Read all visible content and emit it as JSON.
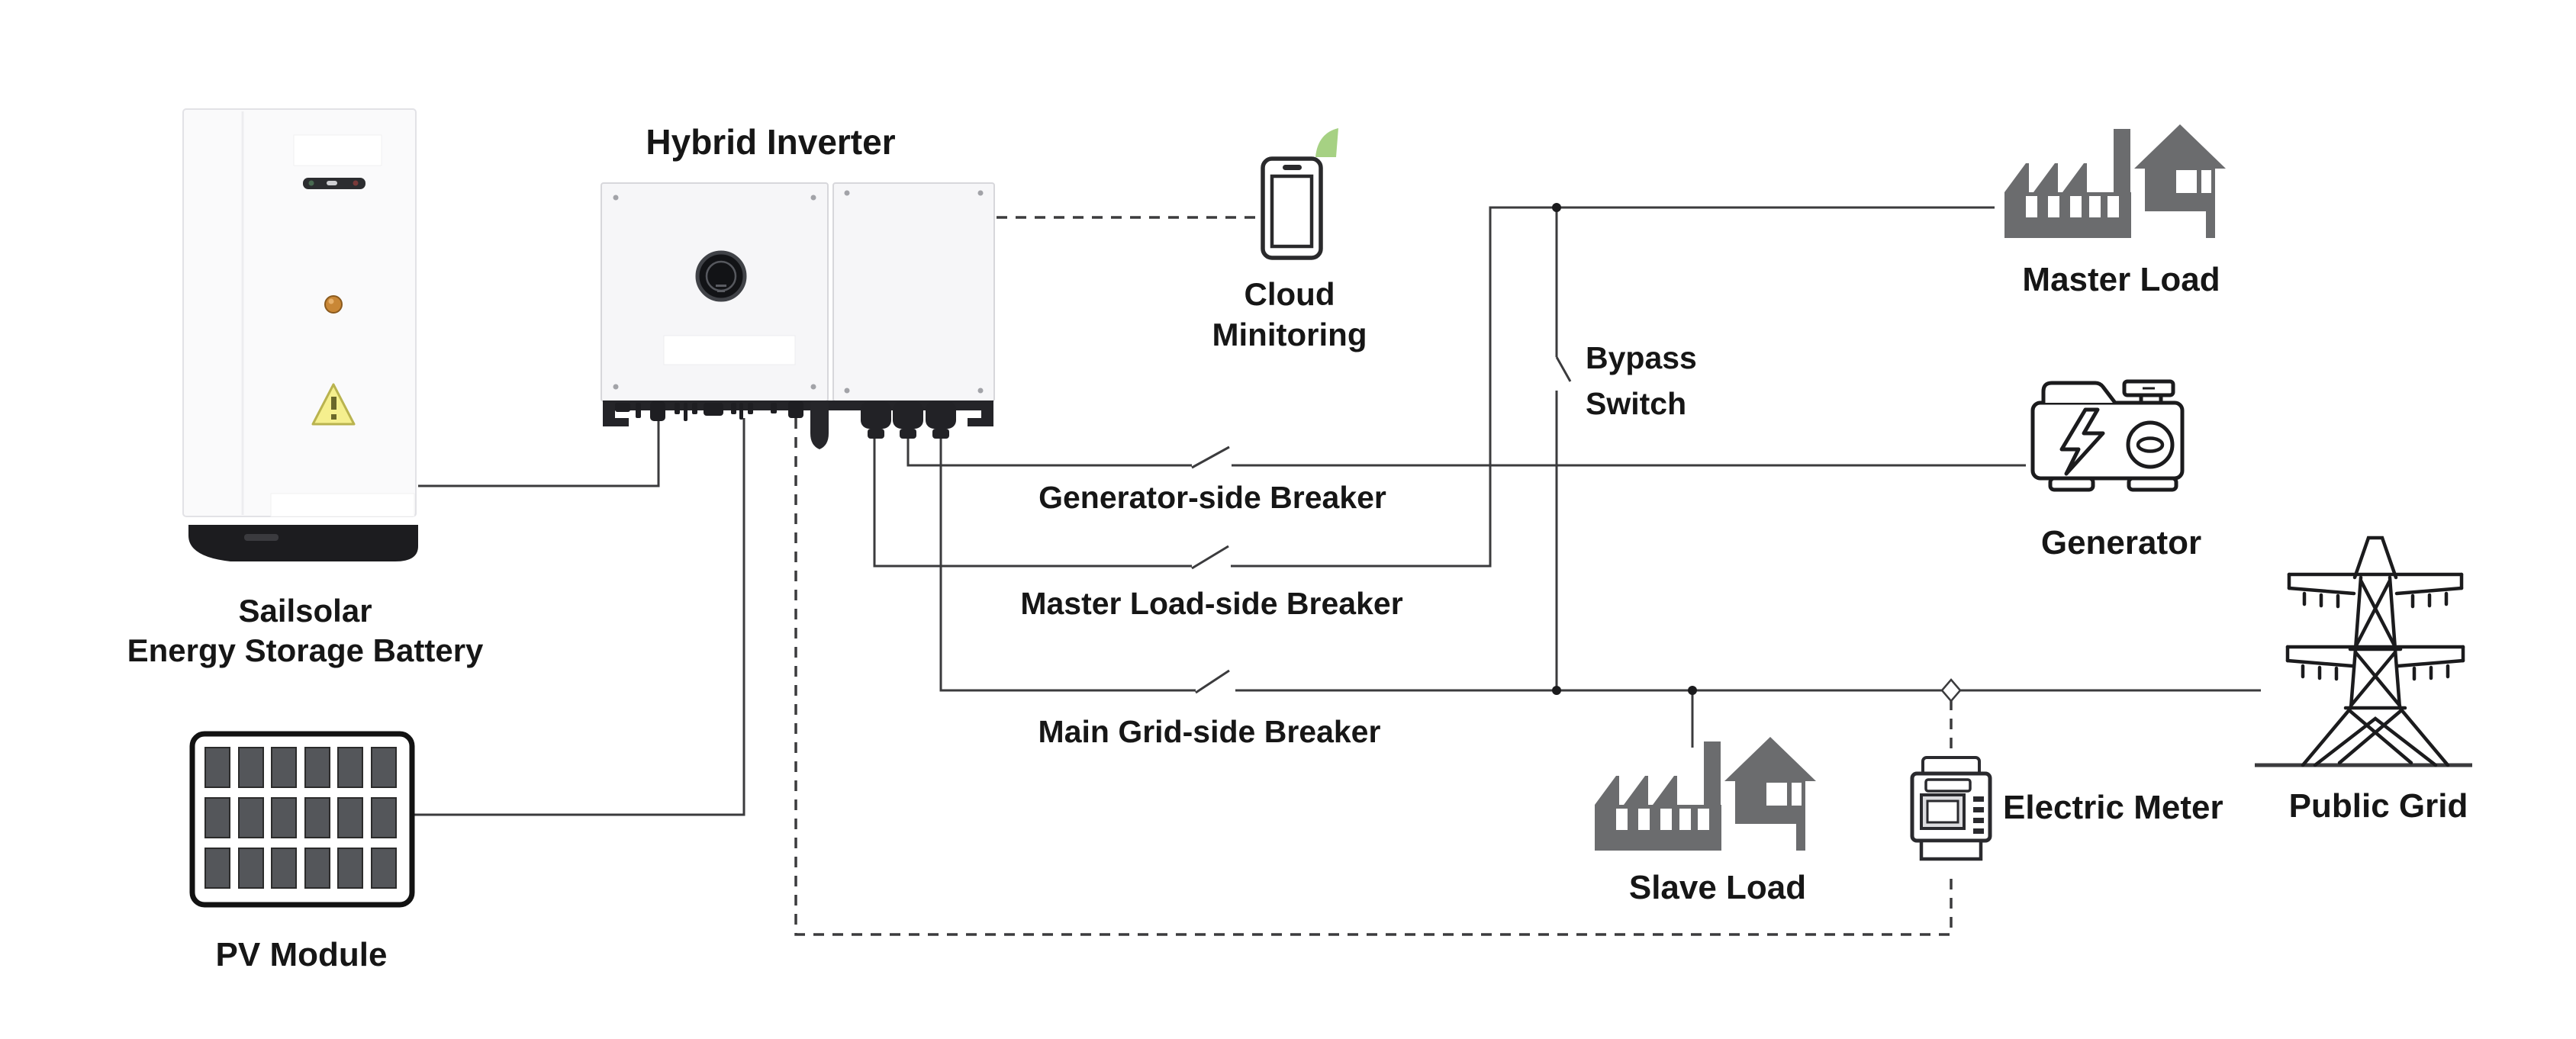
{
  "diagram_title": "Hybrid inverter energy storage system wiring diagram",
  "labels": {
    "hybrid_inverter": "Hybrid Inverter",
    "cloud_monitoring": "Cloud\nMinitoring",
    "battery": "Sailsolar\nEnergy Storage Battery",
    "pv_module": "PV Module",
    "generator_side_breaker": "Generator-side Breaker",
    "master_load_side_breaker": "Master Load-side Breaker",
    "main_grid_side_breaker": "Main Grid-side Breaker",
    "bypass_switch": "Bypass\nSwitch",
    "master_load": "Master Load",
    "generator": "Generator",
    "public_grid": "Public Grid",
    "slave_load": "Slave Load",
    "electric_meter": "Electric Meter"
  },
  "icons": {
    "battery": "battery-cabinet-icon",
    "pv_module": "solar-panel-icon",
    "hybrid_inverter": "inverter-unit-icon",
    "cloud_monitoring": "smartphone-with-signal-icon",
    "master_load": "factory-house-silhouette-icon",
    "slave_load": "factory-house-silhouette-icon",
    "generator": "generator-outline-icon",
    "public_grid": "transmission-tower-icon",
    "electric_meter": "electric-meter-outline-icon",
    "breaker": "breaker-blade-symbol",
    "bypass_switch": "switch-blade-symbol",
    "junction": "junction-dot",
    "meter_tap": "diamond-tap-marker"
  },
  "colors": {
    "background": "#ffffff",
    "wire": "#3b3b3d",
    "text": "#161616",
    "load_silhouette": "#6b6c6e",
    "line_icon": "#1b1b1d",
    "signal_green": "#a6d183",
    "warning_yellow": "#f5ef8e",
    "indicator_orange": "#c98736",
    "panel_fill": "#f6f6f8",
    "connector_black": "#222226"
  },
  "line_styles": {
    "solid_power": "solid",
    "communication": "dashed"
  }
}
